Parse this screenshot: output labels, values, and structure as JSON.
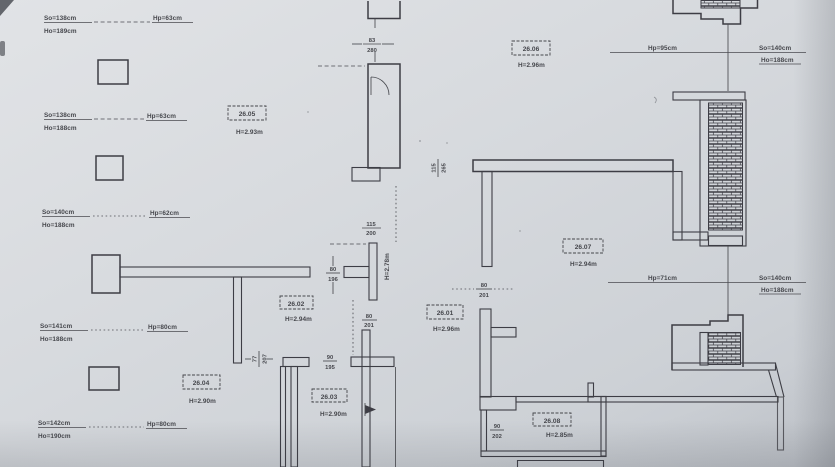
{
  "drawing": {
    "kind": "scanned architectural floor plan",
    "paper_color": "#d6d9dd",
    "ink_color": "#3d3e44"
  },
  "win": [
    {
      "so": "So=138cm",
      "ho": "Ho=189cm",
      "hp": "Hp=63cm"
    },
    {
      "so": "So=138cm",
      "ho": "Ho=188cm",
      "hp": "Hp=63cm"
    },
    {
      "so": "So=140cm",
      "ho": "Ho=188cm",
      "hp": "Hp=62cm"
    },
    {
      "so": "So=141cm",
      "ho": "Ho=188cm",
      "hp": "Hp=80cm"
    },
    {
      "so": "So=142cm",
      "ho": "Ho=190cm",
      "hp": "Hp=80cm"
    },
    {
      "so": "So=140cm",
      "ho": "Ho=188cm",
      "hp": "Hp=95cm"
    },
    {
      "so": "So=140cm",
      "ho": "Ho=188cm",
      "hp": "Hp=71cm"
    }
  ],
  "room": [
    {
      "no": "26.05",
      "h": "H=2.93m"
    },
    {
      "no": "26.06",
      "h": "H=2.96m"
    },
    {
      "no": "26.07",
      "h": "H=2.94m"
    },
    {
      "no": "26.02",
      "h": "H=2.94m"
    },
    {
      "no": "26.01",
      "h": "H=2.96m"
    },
    {
      "no": "26.04",
      "h": "H=2.90m"
    },
    {
      "no": "26.03",
      "h": "H=2.90m"
    },
    {
      "no": "26.08",
      "h": "H=2.85m"
    }
  ],
  "open": [
    {
      "n": "83",
      "d": "280"
    },
    {
      "n": "115",
      "d": "265"
    },
    {
      "n": "115",
      "d": "200"
    },
    {
      "n": "80",
      "d": "196"
    },
    {
      "n": "80",
      "d": "201"
    },
    {
      "n": "80",
      "d": "201"
    },
    {
      "n": "77",
      "d": "207"
    },
    {
      "n": "90",
      "d": "202"
    },
    {
      "n": "90",
      "d": "195"
    }
  ],
  "note": {
    "corridor_height": "H=2.78m"
  }
}
